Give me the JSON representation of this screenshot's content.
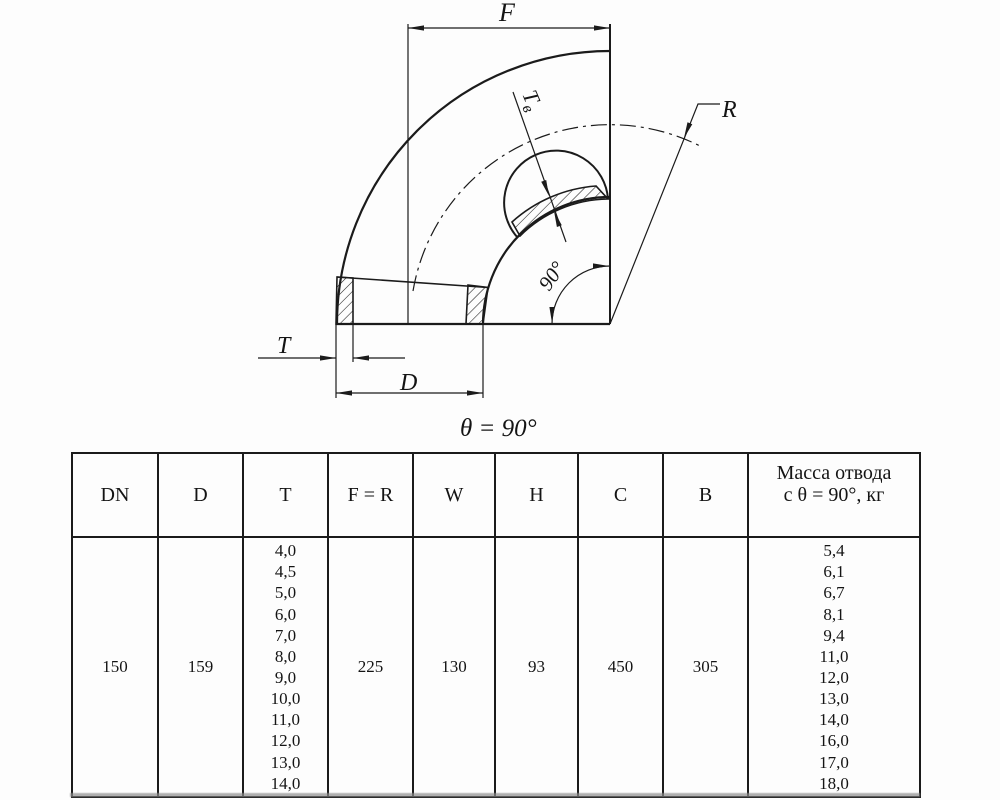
{
  "drawing": {
    "labels": {
      "f": "F",
      "r": "R",
      "t": "T",
      "d": "D",
      "tv_main": "T",
      "tv_sub": "в",
      "angle": "90°",
      "theta_caption": "θ = 90°"
    }
  },
  "table": {
    "headers": [
      "DN",
      "D",
      "T",
      "F = R",
      "W",
      "H",
      "C",
      "B"
    ],
    "mass_header": {
      "line1": "Масса отвода",
      "line2": "с θ =  90°, кг"
    },
    "row": {
      "dn": "150",
      "d": "159",
      "t_values": [
        "4,0",
        "4,5",
        "5,0",
        "6,0",
        "7,0",
        "8,0",
        "9,0",
        "10,0",
        "11,0",
        "12,0",
        "13,0",
        "14,0"
      ],
      "f_r": "225",
      "w": "130",
      "h": "93",
      "c": "450",
      "b": "305",
      "mass_values": [
        "5,4",
        "6,1",
        "6,7",
        "8,1",
        "9,4",
        "11,0",
        "12,0",
        "13,0",
        "14,0",
        "16,0",
        "17,0",
        "18,0"
      ]
    }
  }
}
